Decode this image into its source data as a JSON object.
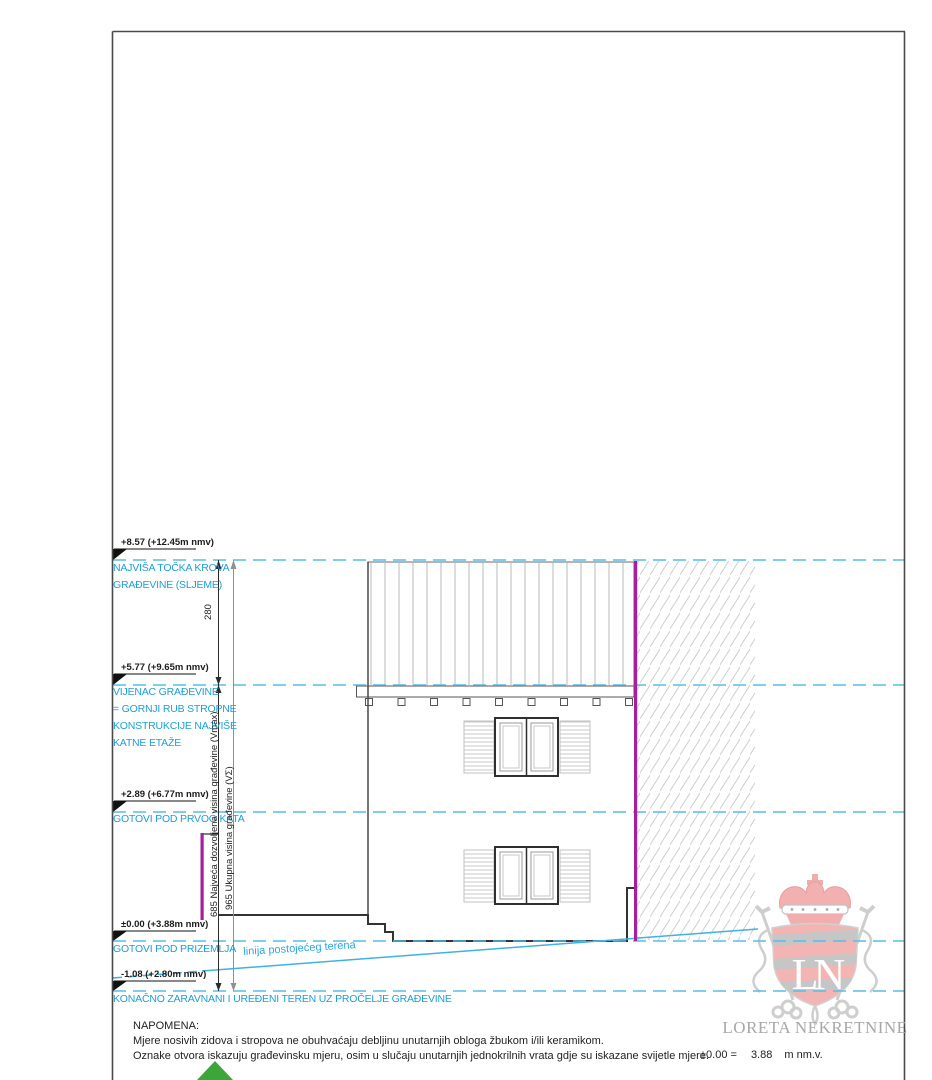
{
  "drawing": {
    "type": "building-elevation",
    "levels": [
      {
        "elevation": "+8.57 (+12.45m nmv)",
        "label_lines": [
          "NAJVIŠA TOČKA KROVA",
          "GRAĐEVINE (SLJEME)"
        ]
      },
      {
        "elevation": "+5.77 (+9.65m nmv)",
        "label_lines": [
          "VIJENAC GRAĐEVINE",
          "= GORNJI RUB STROPNE",
          "KONSTRUKCIJE NAJVIŠE",
          "KATNE ETAŽE"
        ]
      },
      {
        "elevation": "+2.89 (+6.77m nmv)",
        "label_lines": [
          "GOTOVI POD PRVOG KATA"
        ]
      },
      {
        "elevation": "±0.00 (+3.88m nmv)",
        "label_lines": [
          "GOTOVI POD PRIZEMLJA"
        ]
      },
      {
        "elevation": "-1.08 (+2.80m nmv)",
        "label_lines": [
          "KONAČNO ZARAVNANI I UREĐENI TEREN UZ PROČELJE GRAĐEVINE"
        ]
      }
    ],
    "dimensions": {
      "roof_to_ridge": "280",
      "max_allowed": "685 Najveća dozvoljena visina građevine (Vmax)",
      "total": "965 Ukupna visina građevine (VΣ)"
    },
    "terrain": {
      "label": "linija postojećeg terena"
    }
  },
  "notes": {
    "heading": "NAPOMENA:",
    "lines": [
      "Mjere nosivih zidova i stropova ne obuhvaćaju debljinu unutarnjih obloga žbukom i/ili keramikom.",
      "Oznake otvora iskazuju građevinsku mjeru, osim u slučaju unutarnjih jednokrilnih vrata gdje su iskazane svijetle mjere."
    ]
  },
  "datum": {
    "label": "±0.00 =",
    "value": "3.88",
    "unit": "m nm.v."
  },
  "logo": {
    "monogram": "LN",
    "company": "LORETA NEKRETNINE"
  },
  "colors": {
    "level_line": "#58bbe8",
    "level_text": "#1f9ed6",
    "boundary_magenta": "#a51f9f",
    "terrain_cyan": "#3fb1e2",
    "marker_green": "#3da639",
    "logo_pink": "#f2a3a3",
    "logo_gray": "#bdbdbd"
  }
}
